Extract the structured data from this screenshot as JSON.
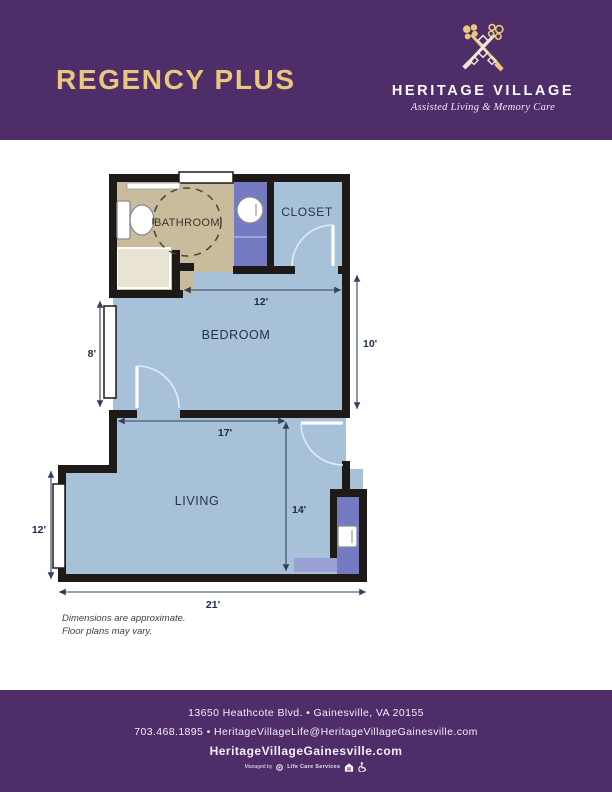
{
  "header": {
    "plan_name": "REGENCY PLUS",
    "brand_name": "HERITAGE VILLAGE",
    "brand_tagline": "Assisted Living & Memory Care"
  },
  "floor_plan": {
    "rooms": {
      "bathroom": "BATHROOM",
      "closet": "CLOSET",
      "bedroom": "BEDROOM",
      "living": "LIVING"
    },
    "dimensions": {
      "bedroom_width": "12'",
      "bedroom_height": "10'",
      "bedroom_left": "8'",
      "living_width": "17'",
      "living_height": "14'",
      "living_left": "12'",
      "overall_width": "21'"
    },
    "notes": {
      "line1": "Dimensions are approximate.",
      "line2": "Floor plans may vary."
    }
  },
  "footer": {
    "address": "13650 Heathcote Blvd. • Gainesville, VA 20155",
    "contact": "703.468.1895 • HeritageVillageLife@HeritageVillageGainesville.com",
    "website": "HeritageVillageGainesville.com",
    "managed_by": "Managed by",
    "management_company": "Life Care Services"
  },
  "colors": {
    "brand_purple": "#4e2d69",
    "gold": "#e9c87d",
    "floor_blue": "#a7c2d8",
    "fixture_purple": "#757bc2",
    "bathroom_tan": "#c9bc9c",
    "wall_black": "#1e1a17"
  }
}
